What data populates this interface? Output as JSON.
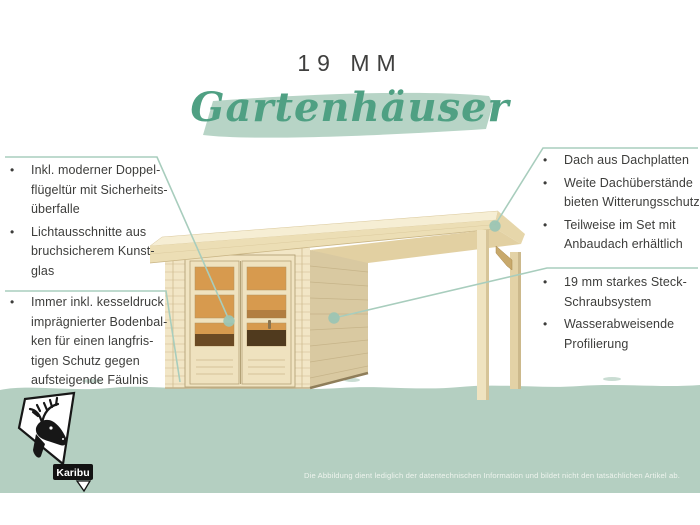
{
  "header": {
    "title": "19 MM",
    "banner_text": "Gartenhäuser"
  },
  "callouts": {
    "top_left": {
      "items": [
        "Inkl. moderner Doppel-\nflügeltür mit Sicherheits-\nüberfalle",
        "Lichtausschnitte aus\nbruchsicherem Kunst-\nglas"
      ]
    },
    "bottom_left": {
      "items": [
        "Immer inkl. kesseldruck\nimprägnierter Bodenbal-\nken für einen langfris-\ntigen Schutz gegen\naufsteigende Fäulnis"
      ]
    },
    "top_right": {
      "items": [
        "Dach aus Dachplatten",
        "Weite Dachüberstände\nbieten Witterungsschutz",
        "Teilweise im Set mit\nAnbaudach erhältlich"
      ]
    },
    "bottom_right": {
      "items": [
        "19 mm starkes Steck-\nSchraubsystem",
        "Wasserabweisende\nProfilierung"
      ]
    }
  },
  "logo": {
    "brand": "Karibu"
  },
  "footer": {
    "disclaimer": "Die Abbildung dient lediglich der datentechnischen Information und bildet nicht den tatsächlichen Artikel ab."
  },
  "colors": {
    "accent_green": "#4fa083",
    "banner_background": "#b7d4c6",
    "ground_band": "#b4cfc1",
    "callout_line": "#a8cdbd",
    "body_text": "#3d3d3b",
    "wood_light": "#f2e6c6",
    "wood_side_wall": "#d9c9a1",
    "window_glass": "#d79a4e"
  }
}
